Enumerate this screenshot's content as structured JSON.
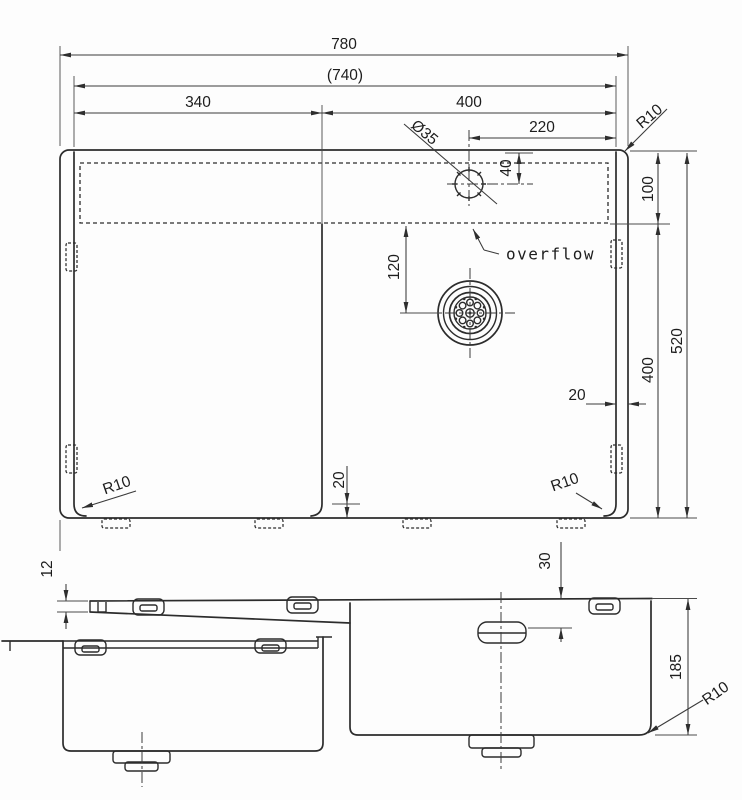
{
  "drawing": {
    "kind": "kitchen sink technical drawing, two views"
  },
  "top_view": {
    "dims": {
      "overall_width": "780",
      "inner_width": "(740)",
      "left_bowl_width": "340",
      "right_bowl_width": "400",
      "faucet_offset": "220",
      "faucet_hole_dia": "Ø35",
      "faucet_from_edge": "40",
      "corner_top_right": "R10",
      "ledge_depth": "100",
      "bowl_front_depth": "400",
      "overall_depth": "520",
      "drain_offset": "120",
      "edge_gap_right": "20",
      "divider_gap": "20",
      "corner_bottom_left": "R10",
      "corner_bottom_right": "R10"
    },
    "labels": {
      "overflow": "overflow"
    }
  },
  "front_view": {
    "dims": {
      "rim_thickness": "12",
      "overflow_from_rim": "30",
      "bowl_depth": "185",
      "corner_radius": "R10"
    }
  },
  "colors": {
    "line": "#2c2c2c",
    "dimension": "#3a3a3a",
    "background": "#fdfdfd"
  }
}
